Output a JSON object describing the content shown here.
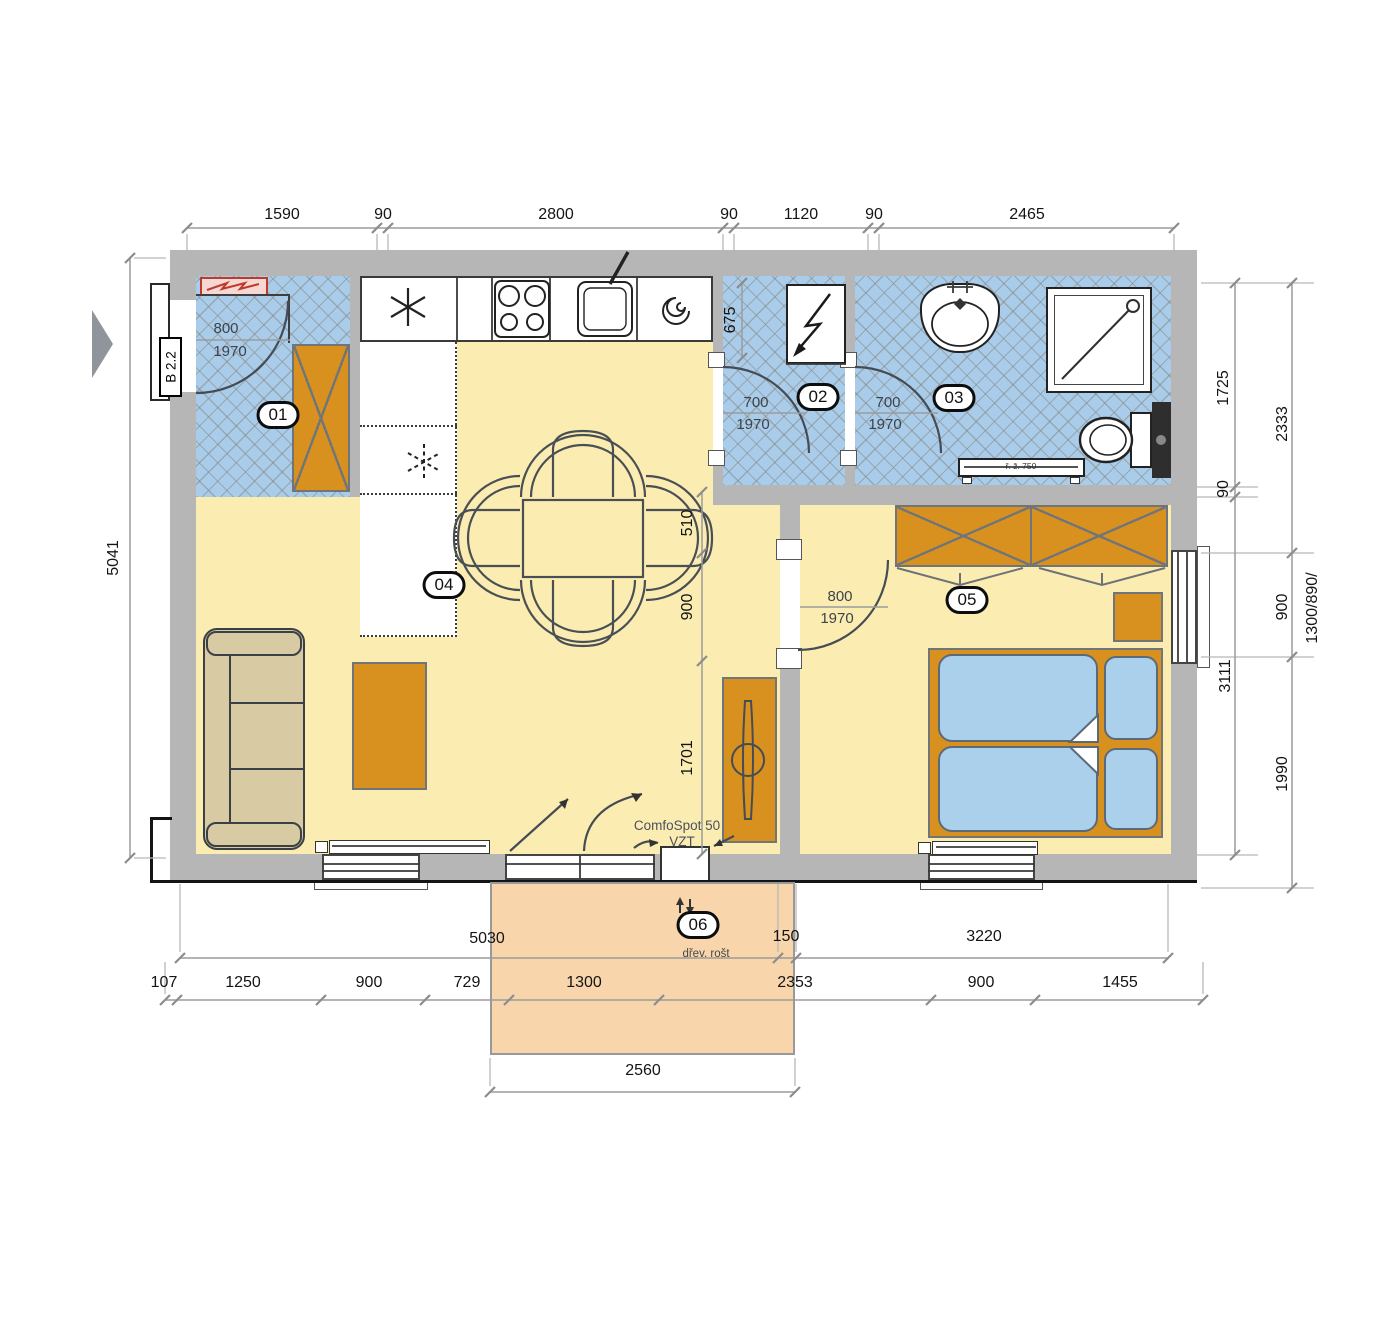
{
  "rooms": {
    "hall": "01",
    "toilet": "02",
    "bathroom": "03",
    "living": "04",
    "bedroom": "05",
    "terrace": "06"
  },
  "entrance": {
    "door_code": "B 2.2",
    "door_width": "800",
    "door_height": "1970"
  },
  "doors": {
    "toilet": {
      "w": "700",
      "h": "1970"
    },
    "bathroom": {
      "w": "700",
      "h": "1970"
    },
    "bedroom": {
      "w": "800",
      "h": "1970"
    }
  },
  "notes": {
    "ventilation1": "ComfoSpot 50",
    "ventilation2": "VZT",
    "terrace_floor": "dřev. rošt",
    "towel_radiator": "ř. ž. 750"
  },
  "dims": {
    "top": [
      "1590",
      "90",
      "2800",
      "90",
      "1120",
      "90",
      "2465"
    ],
    "left": "5041",
    "right_inner": [
      "1725",
      "90",
      "3111"
    ],
    "right_outer": [
      "2333",
      "900",
      "1990"
    ],
    "right_window": "1300/890/",
    "toilet_depth": "675",
    "center": [
      "510",
      "900",
      "1701"
    ],
    "bottom1": [
      "5030",
      "150",
      "3220"
    ],
    "bottom2": [
      "107",
      "1250",
      "900",
      "729",
      "1300",
      "2353",
      "900",
      "1455"
    ],
    "terrace_width": "2560"
  }
}
